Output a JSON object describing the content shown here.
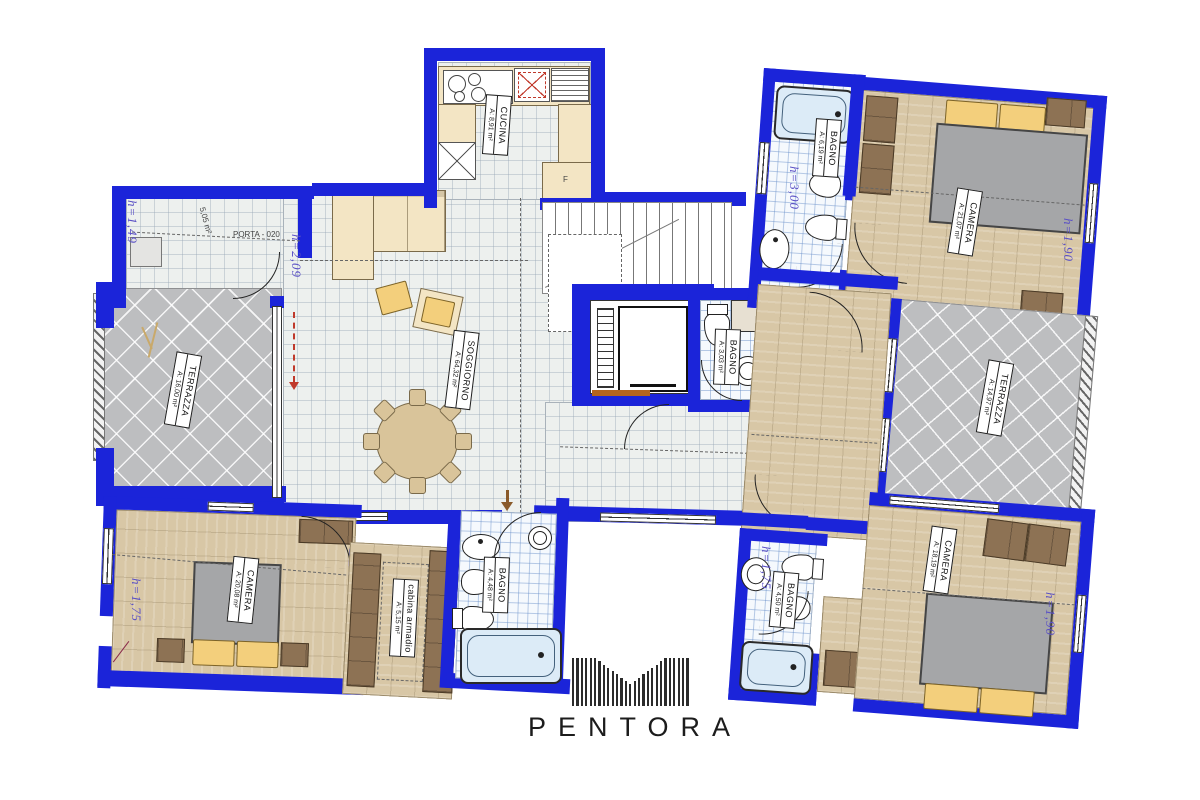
{
  "brand": {
    "name": "PENTORA"
  },
  "plan": {
    "rooms": {
      "cucina": {
        "name": "CUCINA",
        "area": "A: 8,91 m²"
      },
      "soggiorno": {
        "name": "SOGGIORNO",
        "area": "A: 64,32 m²"
      },
      "terrazza_ovest": {
        "name": "TERRAZZA",
        "area": "A: 16,00 m²"
      },
      "terrazza_est": {
        "name": "TERRAZZA",
        "area": "A: 14,97 m²"
      },
      "camera_nord_est": {
        "name": "CAMERA",
        "area": "A: 21,07 m²"
      },
      "bagno_nord_est": {
        "name": "BAGNO",
        "area": "A: 6,19 m²"
      },
      "bagno_centrale": {
        "name": "BAGNO",
        "area": "A: 3,03 m²"
      },
      "camera_sud_ovest": {
        "name": "CAMERA",
        "area": "A: 20,08 m²"
      },
      "cabina_armadio": {
        "name": "cabina armadio",
        "area": "A: 5,15 m²"
      },
      "bagno_sud_ovest": {
        "name": "BAGNO",
        "area": "A: 4,48 m²"
      },
      "bagno_sud_est": {
        "name": "BAGNO",
        "area": "A: 4,50 m²"
      },
      "camera_sud_est": {
        "name": "CAMERA",
        "area": "A: 18,19 m²"
      }
    },
    "heights": {
      "ripostiglio": "h=1,49",
      "soggiorno": "h=2,09",
      "bagno_nord_est": "h=3,00",
      "camera_nord_est": "h=1,90",
      "camera_sud_ovest": "h=1,75",
      "bagno_sud_est": "h=1,75",
      "camera_sud_est": "h=1,90"
    },
    "annotations": {
      "porta": "PORTA - 020",
      "ripostiglio_area": "5,05 m²",
      "kitchen_f": "F"
    },
    "colors": {
      "wall": "#1b24d9",
      "height_label": "#5a50c5",
      "wood_floor": "#d8c7a6",
      "terrace": "#bdbec0",
      "pillow": "#f3cf7c"
    }
  }
}
